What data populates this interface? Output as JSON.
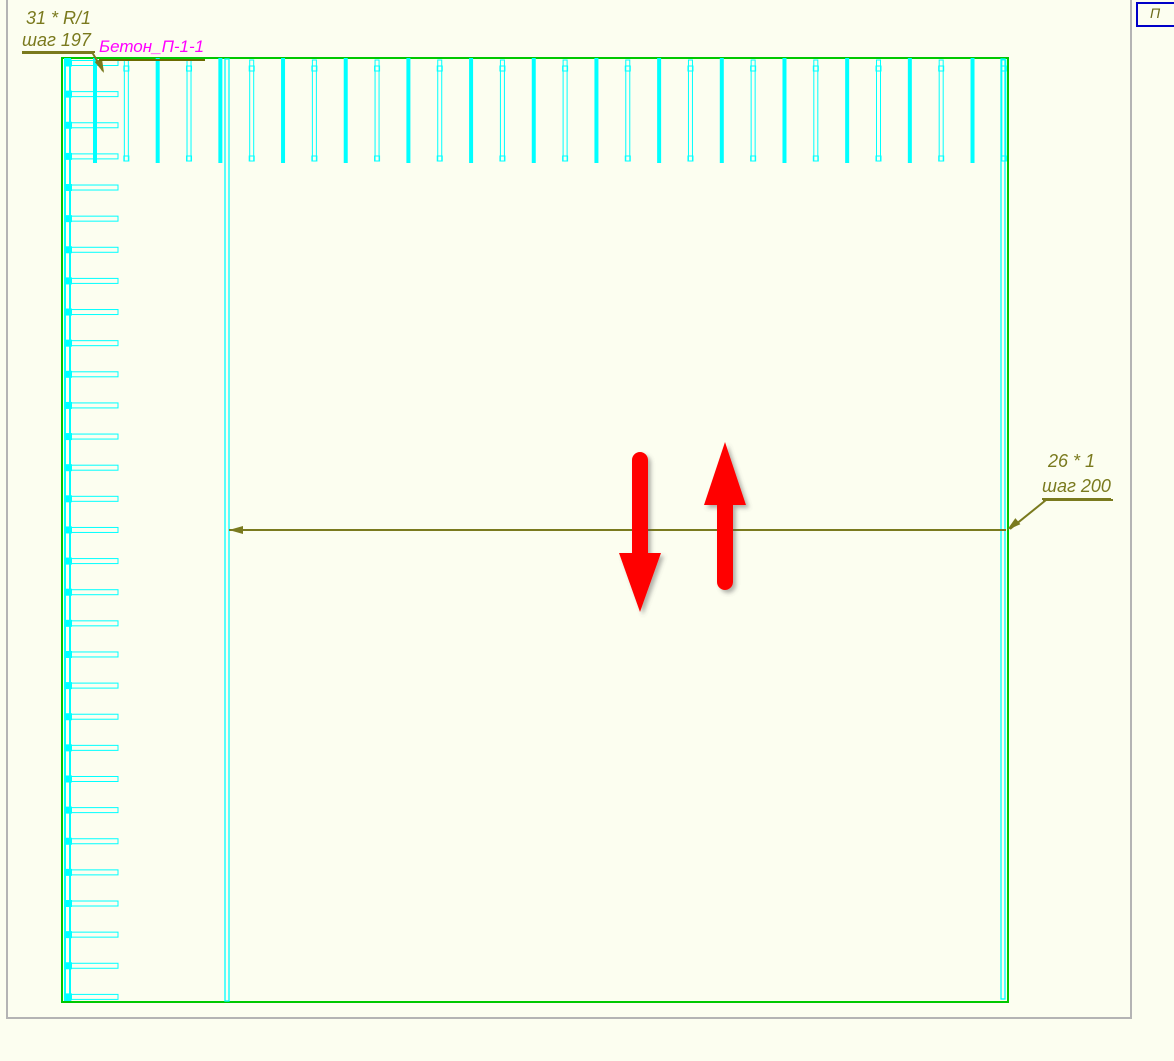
{
  "app": {
    "background_color": "#fcfef0",
    "sheet_border_color": "#b4b4b4"
  },
  "corner_cell": {
    "text": "П",
    "border_color": "#0000c8",
    "text_color": "#6b6b1a"
  },
  "labels": {
    "left_count": "31 * R/1",
    "left_step": "шаг 197",
    "material": "Бетон_П-1-1",
    "right_count": "26 * 1",
    "right_step": "шаг 200",
    "label_color": "#7a7a1e",
    "material_color": "#ff00ff"
  },
  "drawing": {
    "outline": {
      "x": 62,
      "y": 58,
      "w": 946,
      "h": 944,
      "color": "#00c800"
    },
    "rebar_color": "#00ffff",
    "left_bar": {
      "x": 65,
      "y": 59,
      "w": 5,
      "h": 941
    },
    "long_bars": [
      {
        "x": 225,
        "y": 59,
        "w": 4,
        "h": 942
      },
      {
        "x": 1001,
        "y": 59,
        "w": 4,
        "h": 940
      }
    ],
    "top_ticks": {
      "count": 30,
      "x0": 95,
      "step": 31.34,
      "y1": 58,
      "y2": 163,
      "width": 4
    },
    "left_ticks": {
      "count": 31,
      "y0": 63,
      "step": 31.13,
      "x1": 66,
      "x2": 118,
      "height": 5
    },
    "dimension": {
      "color": "#7a7a1e",
      "line": {
        "y": 530,
        "x1": 229,
        "x2": 1006
      },
      "left_arrow": {
        "x": 229,
        "y": 530,
        "rot": 0
      },
      "right_arrow": {
        "x": 1007,
        "y": 530,
        "rot": -39
      }
    },
    "leaders": {
      "color": "#7a7a1e",
      "left_underline": {
        "x1": 22,
        "y1": 52,
        "x2": 95,
        "y2": 52
      },
      "left_leader": {
        "x1": 92,
        "y1": 52,
        "x2": 103,
        "y2": 71
      },
      "left_leader_arrow": {
        "x": 104,
        "y": 73,
        "rot": -114
      },
      "right_underline": {
        "x1": 1043,
        "y1": 500,
        "x2": 1113,
        "y2": 500
      },
      "right_leader": {
        "x1": 1046,
        "y1": 500,
        "x2": 1010,
        "y2": 529
      }
    },
    "red_arrows": {
      "color": "#ff0000",
      "down": {
        "cx": 640,
        "shaft_top": 452,
        "head_top": 553,
        "tip_y": 612,
        "shaft_hw": 8,
        "head_hw": 21
      },
      "up": {
        "cx": 725,
        "shaft_bottom": 590,
        "head_base": 505,
        "tip_y": 442,
        "shaft_hw": 8,
        "head_hw": 21
      }
    }
  }
}
